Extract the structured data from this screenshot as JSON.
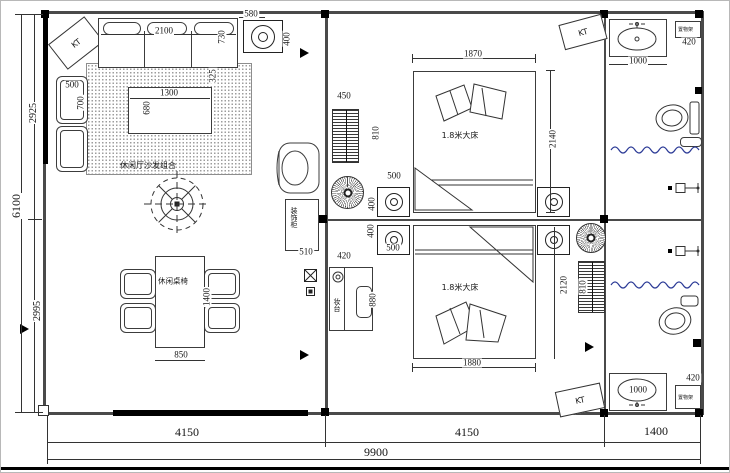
{
  "drawing": {
    "type": "floor-plan",
    "labels": {
      "sofa_group": "休闲厅沙发组合",
      "dining_set": "休闲桌椅",
      "deco_cabinet": "装饰柜",
      "dresser": "妆台",
      "bed_top": "1.8米大床",
      "bed_bottom": "1.8米大床",
      "shelf_top": "置物架",
      "shelf_bottom": "置物架",
      "kt_top_left": "KT",
      "kt_top_right": "KT",
      "kt_bottom_right": "KT"
    },
    "dims": {
      "hood_w": "580",
      "hood_h": "400",
      "sofa_w": "2100",
      "sofa_end": "730",
      "sofa_side": "325",
      "armchair_w": "500",
      "armchair_d": "700",
      "coffee_w": "1300",
      "coffee_d": "680",
      "dining_w": "850",
      "dining_l": "1400",
      "cabinet_w": "510",
      "rad_top_w": "450",
      "rad_top_h": "810",
      "rad_bot_h": "810",
      "ns_top_w": "500",
      "ns_top_h": "400",
      "ns_bot_w": "500",
      "ns_bot_h": "400",
      "bed_top_w": "1870",
      "bed_top_l": "2140",
      "bed_bot_w": "1880",
      "bed_bot_l": "2120",
      "dresser_w": "420",
      "dresser_l": "880",
      "basin_top_w": "1000",
      "basin_bot_w": "1000",
      "shelf_top_w": "420",
      "shelf_bot_w": "420",
      "bay_left": "4150",
      "bay_mid": "4150",
      "bay_right": "1400",
      "total_w": "9900",
      "total_h": "6100",
      "seg_top": "2925",
      "seg_bot": "2995"
    },
    "colors": {
      "line": "#3c3c3c",
      "water_blue": "#2b3a96"
    }
  }
}
